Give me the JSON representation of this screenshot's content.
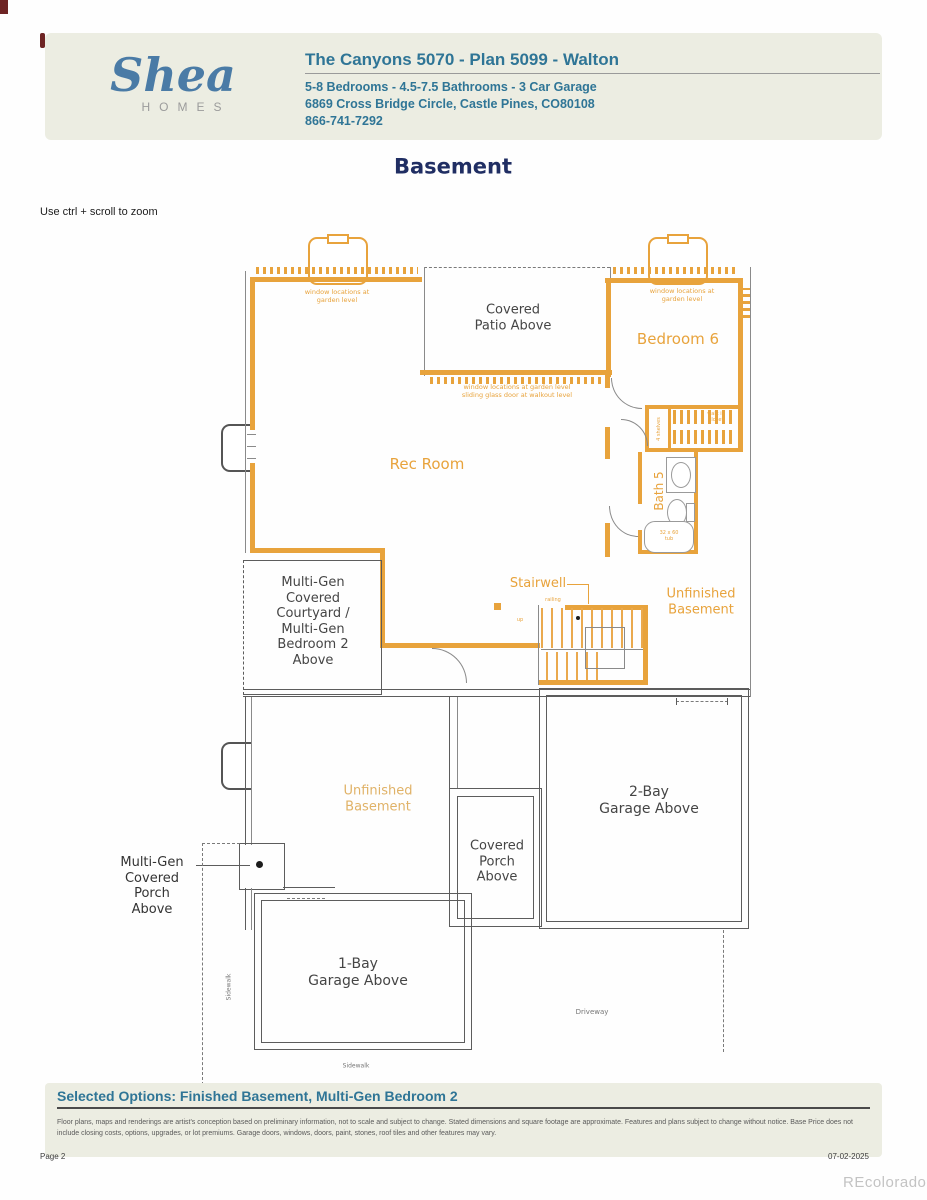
{
  "header": {
    "logo_script": "Shea",
    "logo_sub": "HOMES",
    "title": "The Canyons 5070 - Plan 5099 - Walton",
    "specs": "5-8 Bedrooms - 4.5-7.5 Bathrooms - 3 Car Garage",
    "address": "6869 Cross Bridge Circle, Castle Pines, CO80108",
    "phone": "866-741-7292"
  },
  "plan": {
    "title": "Basement",
    "zoom_hint": "Use ctrl + scroll to zoom"
  },
  "floorplan": {
    "labels": {
      "covered_patio": "Covered\nPatio Above",
      "bedroom6": "Bedroom 6",
      "rec_room": "Rec Room",
      "bath5": "Bath 5",
      "walk_in_closet": "walk in\ncloset",
      "shelves": "4 shelves",
      "stairwell": "Stairwell",
      "railing": "railing",
      "up": "up",
      "unfinished_basement_right": "Unfinished\nBasement",
      "multigen_courtyard": "Multi-Gen\nCovered\nCourtyard /\nMulti-Gen\nBedroom 2\nAbove",
      "unfinished_basement_left": "Unfinished\nBasement",
      "multigen_porch": "Multi-Gen\nCovered\nPorch\nAbove",
      "covered_porch": "Covered\nPorch\nAbove",
      "garage_2bay": "2-Bay\nGarage Above",
      "garage_1bay": "1-Bay\nGarage Above",
      "tub": "32 x 60\ntub"
    },
    "notes": {
      "window_note_left": "window locations at\ngarden level",
      "window_note_right": "window locations at\ngarden level",
      "window_note_patio": "window locations at garden level\nsliding glass door at walkout level",
      "sidewalk_vertical": "Sidewalk",
      "sidewalk_bottom": "Sidewalk",
      "driveway": "Driveway"
    }
  },
  "footer": {
    "selected_options": "Selected Options: Finished Basement, Multi-Gen Bedroom 2",
    "disclaimer": "Floor plans, maps and renderings are artist's conception based on preliminary information, not to scale and subject to change. Stated dimensions and square footage are approximate. Features and plans subject to change without notice. Base Price does not include closing costs, options, upgrades, or lot premiums. Garage doors, windows, doors, paint, stones, roof tiles and other features may vary.",
    "page_number": "Page 2",
    "date": "07-02-2025",
    "watermark": "REcolorado"
  },
  "colors": {
    "wall_orange": "#e8a33c",
    "header_teal": "#2f7596",
    "navy": "#202e63",
    "band_bg": "#ecede2",
    "line_gray": "#5c5c5c"
  }
}
